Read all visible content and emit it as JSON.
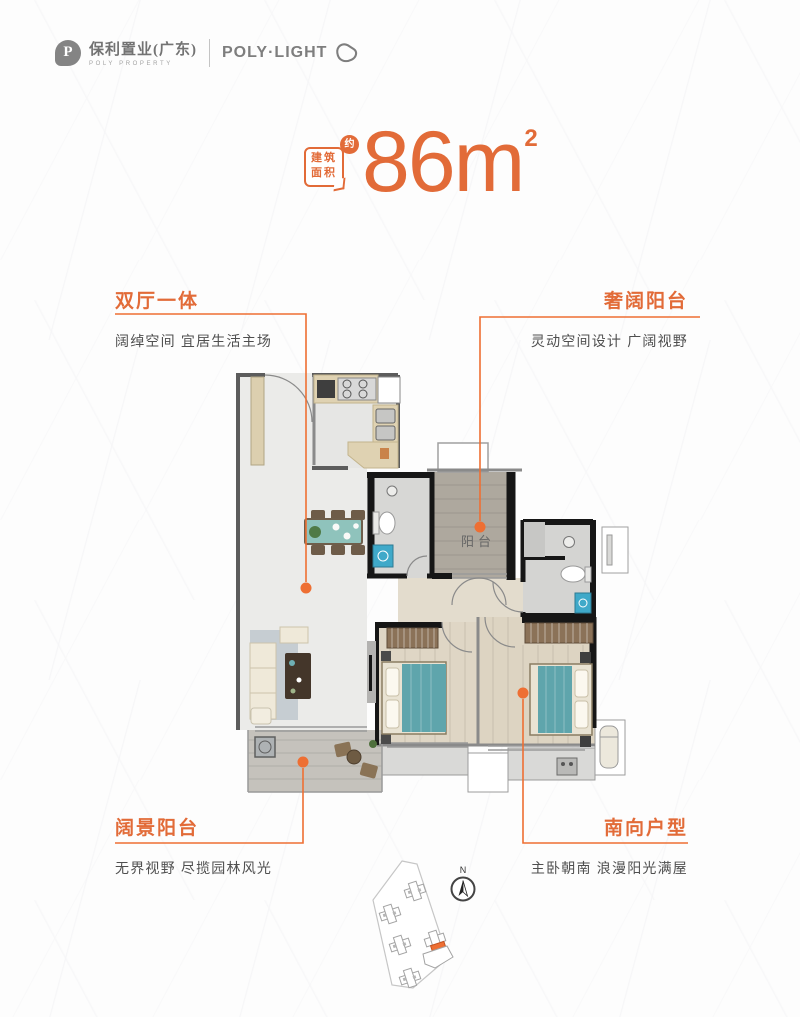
{
  "brand": {
    "mark": "P",
    "name_cn": "保利置业(广东)",
    "name_en": "POLY PROPERTY",
    "product": "POLY·LIGHT"
  },
  "headline": {
    "badge_line1": "建筑",
    "badge_line2": "面积",
    "approx": "约",
    "value": "86",
    "unit": "m",
    "sup": "2"
  },
  "callouts": {
    "top_left": {
      "title": "双厅一体",
      "desc": "阔绰空间 宜居生活主场"
    },
    "top_right": {
      "title": "奢阔阳台",
      "desc": "灵动空间设计 广阔视野"
    },
    "bottom_left": {
      "title": "阔景阳台",
      "desc": "无界视野 尽揽园林风光"
    },
    "bottom_right": {
      "title": "南向户型",
      "desc": "主卧朝南 浪漫阳光满屋"
    }
  },
  "floorplan": {
    "balcony_label": "阳台"
  },
  "sitemap": {
    "compass_n": "N"
  },
  "colors": {
    "accent": "#E26B38",
    "leader": "#EE6F33",
    "text": "#4F4F4F",
    "brand_gray": "#848484"
  }
}
